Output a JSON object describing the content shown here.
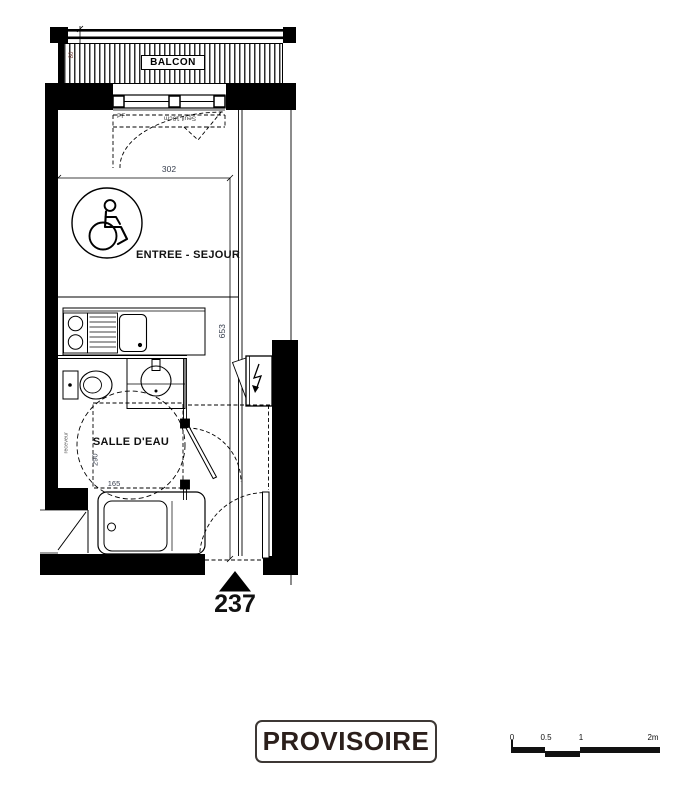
{
  "colors": {
    "wall": "#000000",
    "dimension_text": "#3a4150",
    "balcony_dim_text": "#6e3a31",
    "stamp_text": "#2b1f1b",
    "stamp_border": "#3d3835"
  },
  "plan": {
    "balcony_label": "BALCON",
    "balcony_depth": "80",
    "window_code": "PF",
    "threshold_note": "Seuil 10cm",
    "room_width": "302",
    "entry_living_label": "ENTREE - SEJOUR",
    "room_length": "653",
    "bathroom_label": "SALLE D'EAU",
    "bathroom_length": "290",
    "bathroom_width": "165",
    "wall_note": "receveur",
    "unit_number": "237"
  },
  "stamp": {
    "label": "PROVISOIRE"
  },
  "scale_bar": {
    "labels": [
      "0",
      "0.5",
      "1",
      "2m"
    ]
  }
}
